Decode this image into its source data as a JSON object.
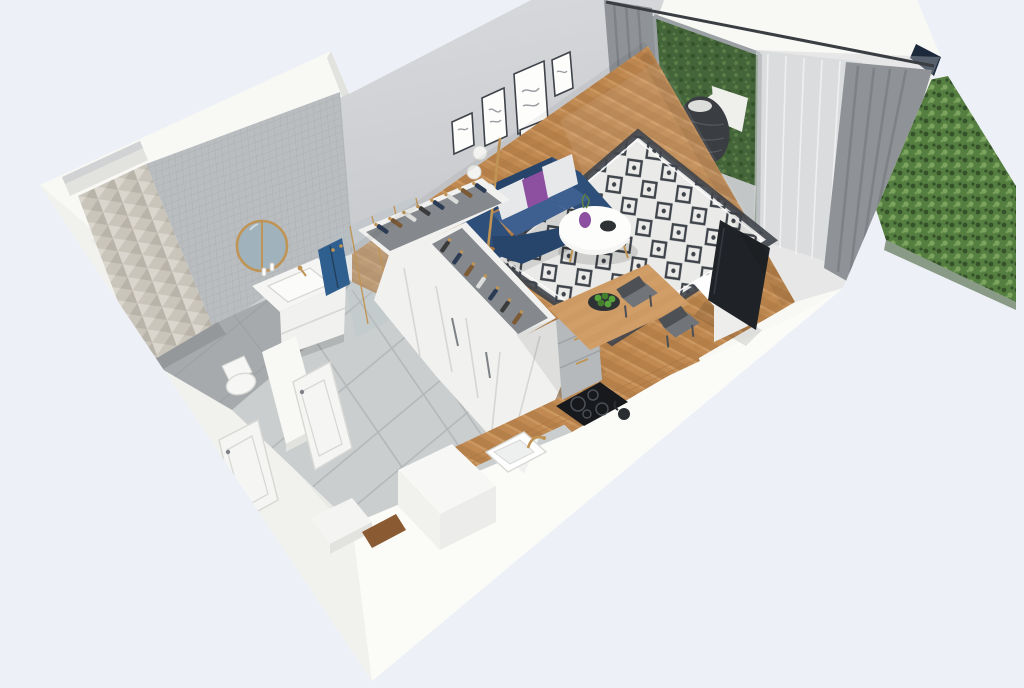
{
  "scene": {
    "description": "Isometric cutaway 3D render of a studio apartment floor plan with bathroom, hallway, wardrobe, living room, kitchen-dining area and a balcony bordered by a green hedge",
    "rooms": [
      {
        "name": "bathroom",
        "features": [
          "chevron tile accent wall",
          "mosaic tile wall",
          "round gold-rim mirror",
          "white vanity with gold faucet",
          "blue towel",
          "glass shower with gold trim",
          "toilet"
        ]
      },
      {
        "name": "hallway",
        "features": [
          "large gray floor tiles",
          "entry door ajar",
          "bathroom door ajar",
          "white step",
          "wood threshold"
        ]
      },
      {
        "name": "wardrobe",
        "features": [
          "L-shaped white closet units",
          "open tops with clothes on gold hangers"
        ]
      },
      {
        "name": "living-room",
        "features": [
          "navy two-seat sofa",
          "purple and white cushions",
          "white round coffee table",
          "black and white diamond rug",
          "floor lamp with three white globes",
          "gallery wall of five framed prints",
          "herringbone oak floor"
        ]
      },
      {
        "name": "kitchen-dining",
        "features": [
          "wood worktop along wall",
          "white sink with gold tap",
          "black induction hob",
          "gray island drawers with gold handles",
          "wood dining table",
          "bowl of green apples",
          "two gray chairs",
          "white tall cabinets"
        ]
      },
      {
        "name": "tv-corner",
        "features": [
          "flat tv leaning on wall",
          "white media cabinet"
        ]
      },
      {
        "name": "balcony",
        "features": [
          "hanging egg chair",
          "sheer and gray curtains",
          "sliding glass door",
          "concrete pavers",
          "wood deck strip",
          "green hedge outside"
        ]
      }
    ]
  },
  "colors": {
    "bg": "#edf1f7",
    "wallTop": "#f8f8f5",
    "wallFaceL": "#f1f1ed",
    "wallFaceR": "#fbfbf8",
    "wallEdge": "#e2e2de",
    "navyTrim": "#1c2a3c",
    "wallInt": "#d9dadd",
    "wallIntDark": "#c6c8cb",
    "baseboard": "#f0f0ee",
    "chevronBase": "#cac5bb",
    "chevronLight": "#dad6cd",
    "chevronDark": "#b3aea3",
    "mosaic": "#b9bdc0",
    "mosaicLine": "#a7abae",
    "bathFloor": "#a6aaad",
    "tileFloor": "#cbcecf",
    "tileLine": "#b5b8b9",
    "tileDark": "#9a9ea1",
    "wood": "#c08a52",
    "woodDark": "#a87340",
    "woodLight": "#d29e68",
    "rugBase": "#eaeae8",
    "rugInk": "#3f444b",
    "sofa": "#2e4f7a",
    "sofaDark": "#27446b",
    "sofaLight": "#3d6090",
    "pillowWhite": "#e7e8ea",
    "pillowPurple": "#8d4fa0",
    "tableWhite": "#f5f5f3",
    "gold": "#c09454",
    "curtain": "#8f9296",
    "curtainDark": "#7a7d81",
    "sheer": "#d3d6d9",
    "glassFrame": "#9aa0a3",
    "glassTint": "#b7c3c9",
    "greenDoor": "#44653a",
    "greenLeaf": "#5d7f47",
    "hedge": "#557e41",
    "hedgeDark": "#36522a",
    "hedgeLight": "#7ca45e",
    "eggDark": "#3a3d41",
    "eggWhite": "#efefec",
    "paver": "#c3c6c6",
    "tv": "#1f2226",
    "tvStand": "#ededeb",
    "cabinetWhite": "#f1f1ef",
    "cabinetSeam": "#d6d6d3",
    "islandGray": "#b5b9bc",
    "islandLine": "#9da1a4",
    "cooktop": "#17191c",
    "ringColor": "#4a4f55",
    "chairSeat": "#71757a",
    "chairDark": "#4d5156",
    "clothesNavy": "#2d3c55",
    "clothesBrown": "#7c5a36",
    "clothesWhite": "#dcdcda",
    "clothesDark": "#3b3b3b",
    "mirrorGlass": "#a0b3bd",
    "towel": "#2f5f8e",
    "doorWhite": "#f5f5f3",
    "doorEdge": "#d8d8d5",
    "handle": "#7e8286",
    "threshold": "#8a5a33",
    "appleGreen": "#57a33a",
    "appleDark": "#447f2d",
    "plate": "#2f3235",
    "channel": "#85898d",
    "shadow": "#000000"
  }
}
